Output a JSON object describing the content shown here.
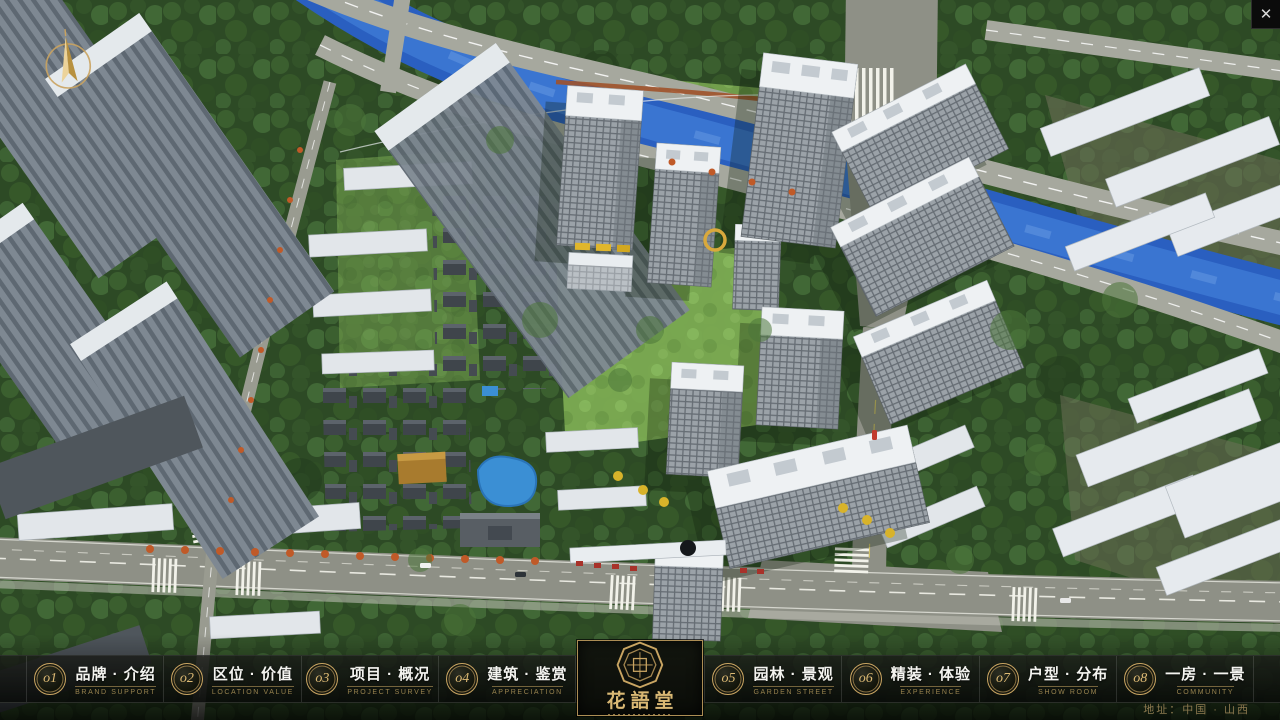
{
  "ui": {
    "close_glyph": "✕",
    "address": "地址：中国 · 山西"
  },
  "logo": {
    "name": "花語堂"
  },
  "nav": {
    "items": [
      {
        "num": "o1",
        "zh": "品牌 · 介绍",
        "en": "BRAND SUPPORT"
      },
      {
        "num": "o2",
        "zh": "区位 · 价值",
        "en": "LOCATION VALUE"
      },
      {
        "num": "o3",
        "zh": "项目 · 概况",
        "en": "PROJECT SURVEY"
      },
      {
        "num": "o4",
        "zh": "建筑 · 鉴赏",
        "en": "APPRECIATION"
      },
      {
        "num": "o5",
        "zh": "园林 · 景观",
        "en": "GARDEN STREET"
      },
      {
        "num": "o6",
        "zh": "精装 · 体验",
        "en": "EXPERIENCE"
      },
      {
        "num": "o7",
        "zh": "户型 · 分布",
        "en": "SHOW ROOM"
      },
      {
        "num": "o8",
        "zh": "一房 · 一景",
        "en": "COMMUNITY"
      }
    ]
  },
  "colors": {
    "accent_gold": "#c9a562",
    "bar_background": "#0a0c08",
    "river_blue": "#2a5fc0",
    "forest_green": "#2d4a25"
  }
}
